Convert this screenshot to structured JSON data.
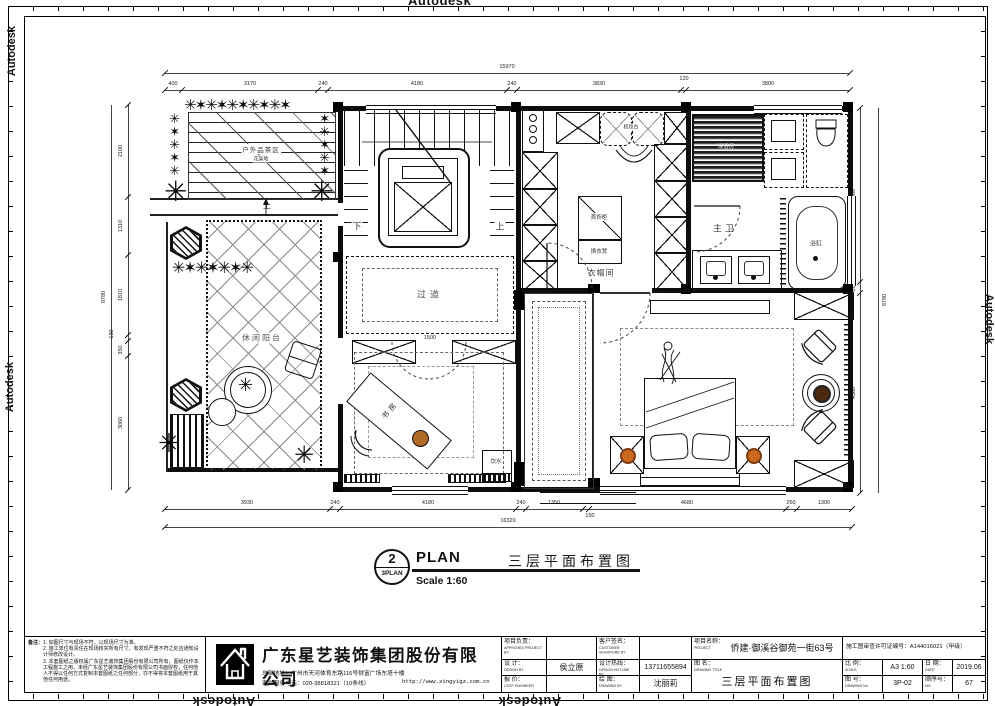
{
  "watermark": "Autodesk",
  "plan": {
    "rooms": {
      "deck": {
        "label": "户外品茶区",
        "sublabel": "花架地",
        "up": "上"
      },
      "balcony": {
        "label": "休闲阳台"
      },
      "stairs": {
        "down": "下",
        "up": "上"
      },
      "corridor": {
        "label": "过道",
        "width_dim": "1500"
      },
      "study": {
        "label": "书房",
        "water": "饮水"
      },
      "cloakroom": {
        "label": "衣帽间",
        "jewelry": "首饰柜",
        "stool": "换衣凳",
        "dresser": "梳妆台"
      },
      "master_bath": {
        "label": "主卫",
        "shower": "淋浴房",
        "tub": "浴缸"
      },
      "master_bedroom": {
        "label": "主卧"
      }
    },
    "dims": {
      "top_total": "15970",
      "top": [
        "400",
        "3170",
        "240",
        "4180",
        "240",
        "3830",
        "120",
        "3800"
      ],
      "bottom": [
        "3930",
        "240",
        "4180",
        "240",
        "1350",
        "150",
        "4680",
        "260",
        "1300"
      ],
      "bottom_total": "16320",
      "left": [
        "2100",
        "1310",
        "1810",
        "130",
        "350",
        "3060"
      ],
      "left_total": "8780",
      "right": [
        "3960",
        "260",
        "4560"
      ],
      "right_total": "8780"
    }
  },
  "plan_title": {
    "num": "2",
    "sub": "3PLAN",
    "en": "PLAN",
    "scale": "Scale 1:60",
    "cn": "三层平面布置图"
  },
  "title_block": {
    "notes_title": "备注：",
    "notes": [
      "1. 如图尺寸与现场不符，以现场尺寸为准。",
      "2. 施工单位有责任在现场核实所有尺寸，有发现严重不符之处应通知设计师修改设计。",
      "3. 本套图纸之版权属广东星艺装饰集团股份有限公司所有，图纸仅作本工程施工之用，未经广东星艺装饰集团股份有限公司书面授权，任何他人不得以任何方式复制本套图纸之任何部分，亦不得将本套图纸用于其他任何用途。"
    ],
    "company": "广东星艺装饰集团股份有限公司",
    "address": "总部地址：广州市天河体育东路116号财富广场东塔十楼",
    "phone": "客户服务电话：020-38818321（10条线）",
    "website": "http://www.xingyigz.com.cn",
    "fields": {
      "approved_cn": "项目负责：",
      "approved_en": "APPROVED PROJECT BY",
      "customer_cn": "客户签名：",
      "customer_en": "CUSTOMER SIGNATURE BY",
      "project_cn": "项目名称：",
      "project_en": "PROJECT",
      "project_value": "侨建·御溪谷御苑一街63号",
      "permit": "施工图审查许可证编号：A144016021（甲级）",
      "design_cn": "设  计：",
      "design_en": "DESIGN BY",
      "design_value": "侯立原",
      "hotline_cn": "设计热线：",
      "hotline_en": "DESIGN HOTLINE BY",
      "hotline_value": "13711655894",
      "title_cn": "图  名：",
      "title_en": "DRAWING  TITLE",
      "title_value": "三层平面布置图",
      "scale_cn": "比 例：",
      "scale_en": "SCALE",
      "scale_value": "A3 1:60",
      "date_cn": "日 期：",
      "date_en": "DATE",
      "date_value": "2019.06",
      "cost_cn": "报  价：",
      "cost_en": "COST ENGINEER",
      "draw_cn": "绘  图：",
      "draw_en": "DRAWING BY",
      "draw_value": "沈丽莉",
      "no_cn": "图 号：",
      "no_en": "DRAWING No",
      "no_value": "3P-02",
      "seq_cn": "顺序号：",
      "seq_en": "NO.",
      "seq_value": "67"
    }
  }
}
